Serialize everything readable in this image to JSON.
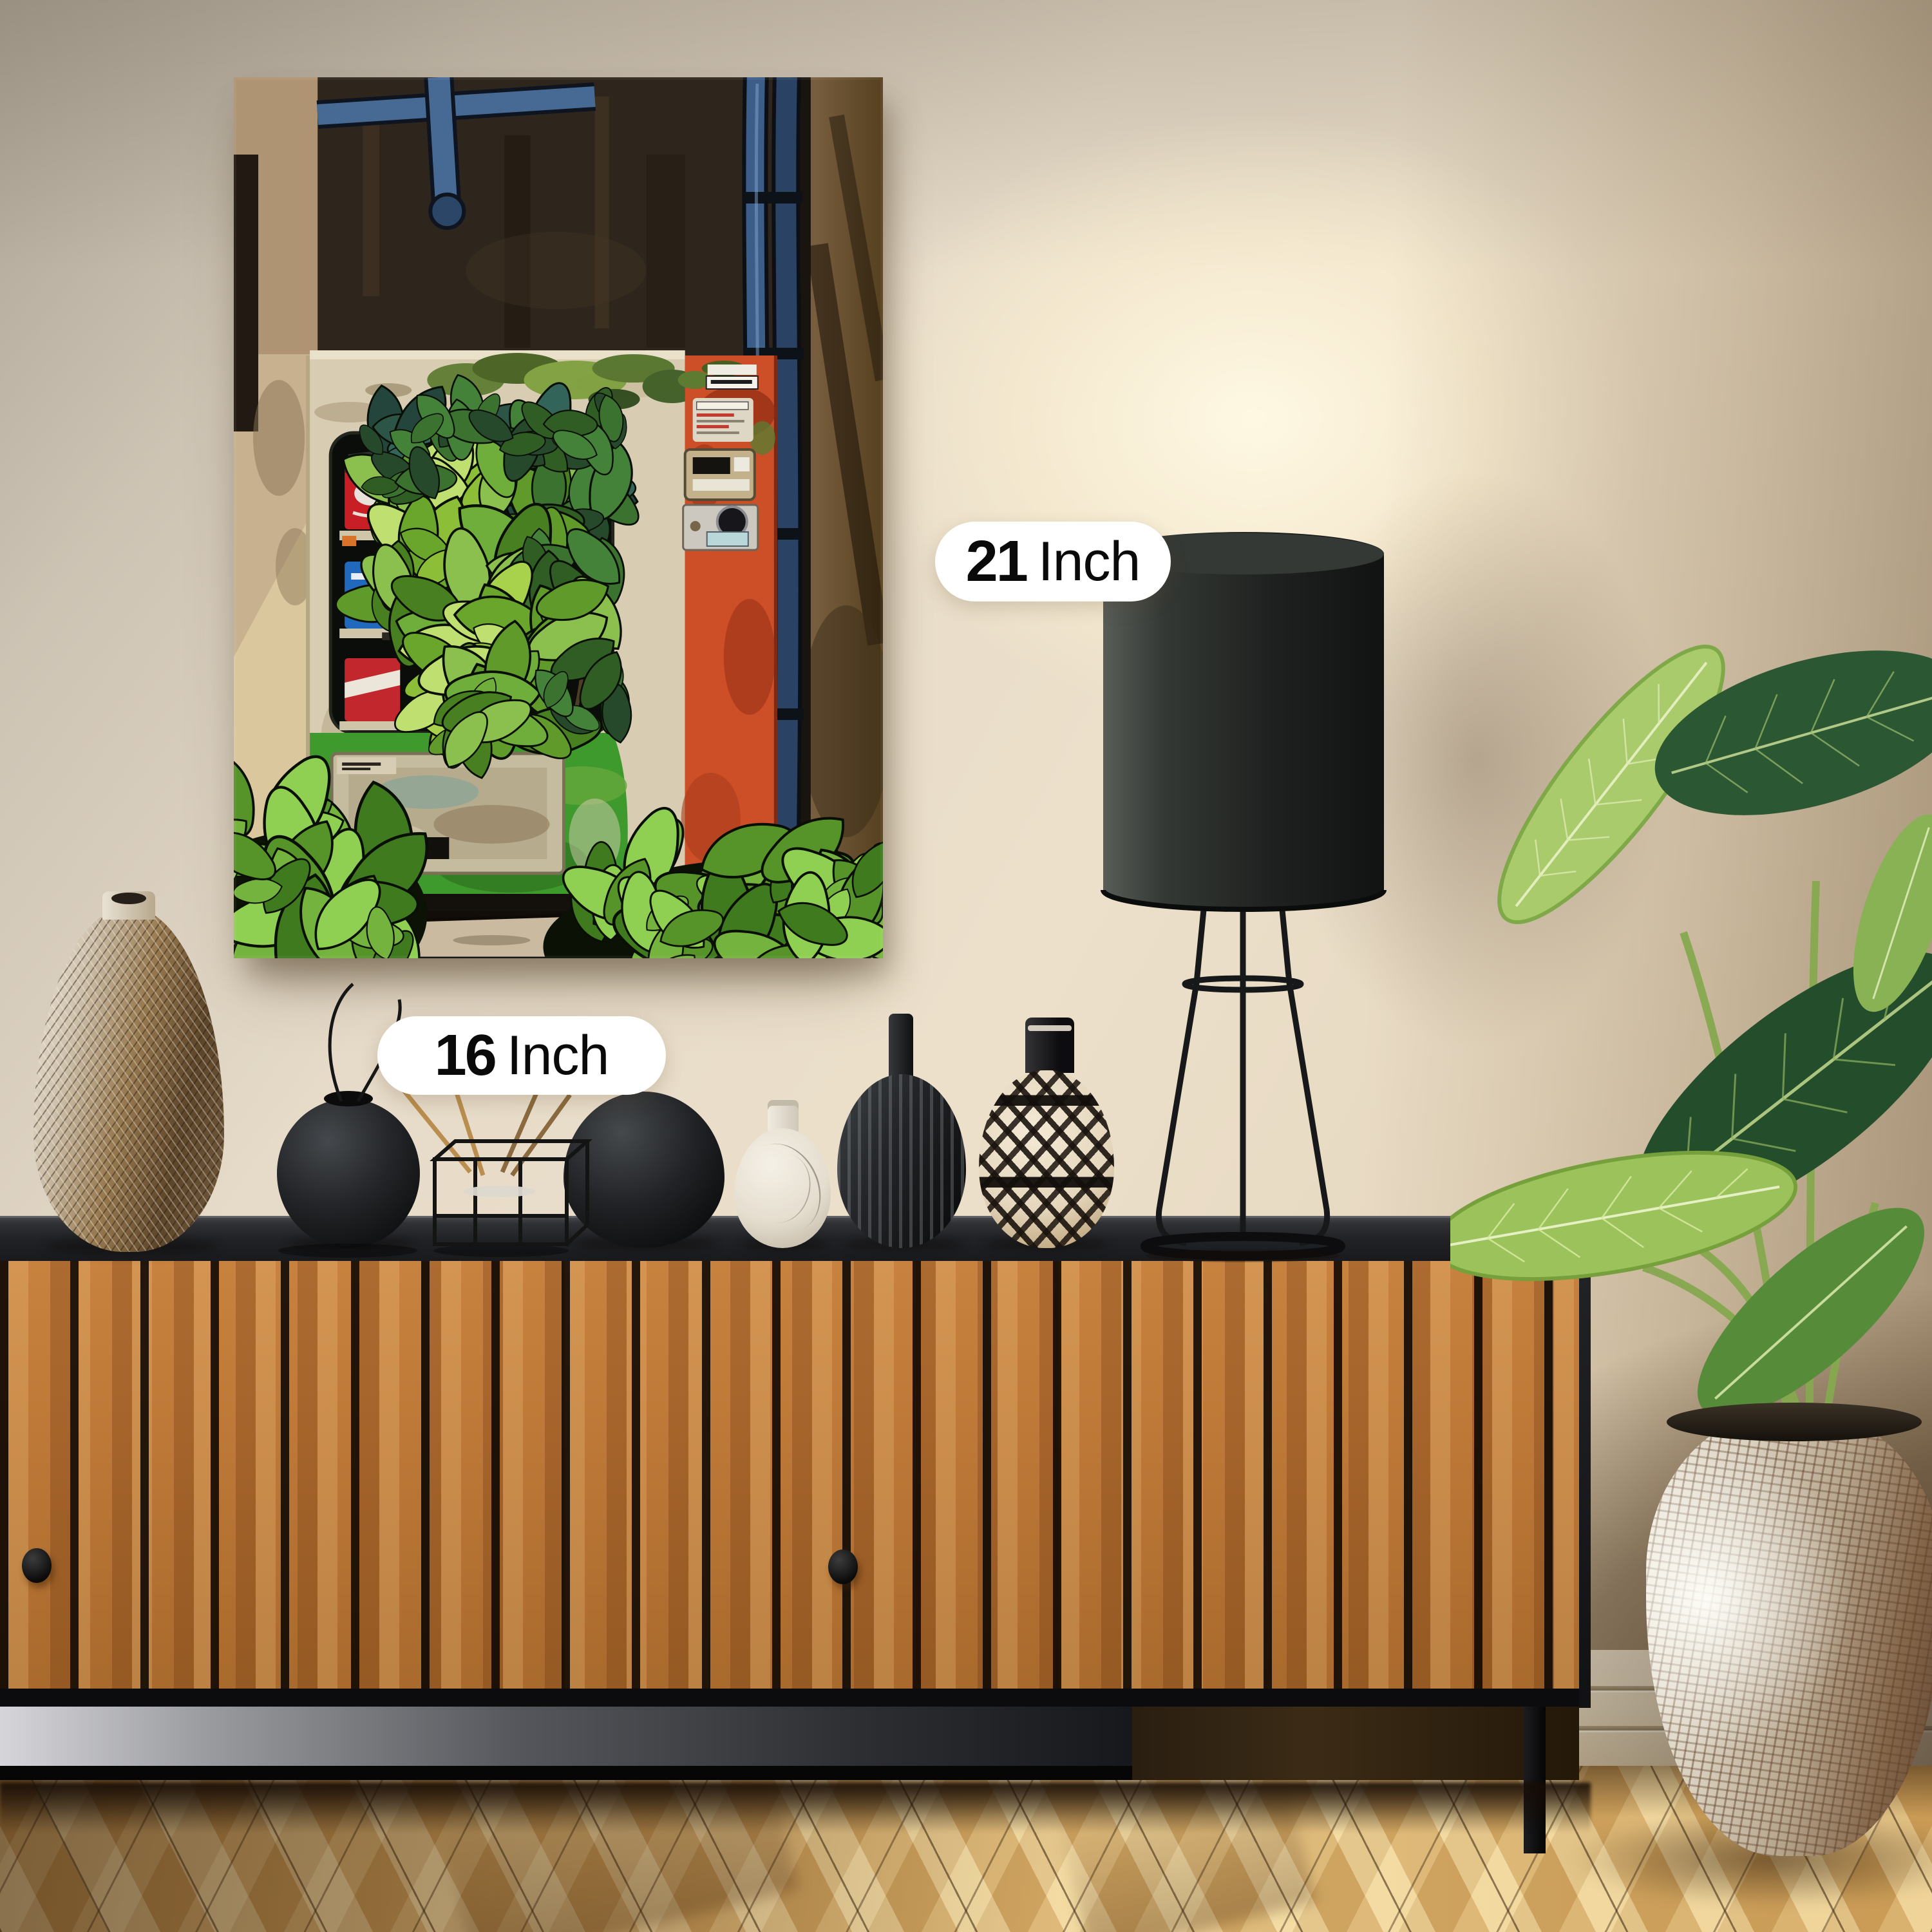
{
  "page": {
    "type": "product-mockup-photo",
    "subject": "Framed wall-art canvas of an overgrown vending machine displayed in a styled living room"
  },
  "annotations": {
    "height_label": {
      "value": "21",
      "unit": "Inch"
    },
    "width_label": {
      "value": "16",
      "unit": "Inch"
    }
  },
  "artwork": {
    "style": "anime-illustration",
    "subject": "abandoned vending machine covered in ivy",
    "orientation": "portrait",
    "palette": {
      "machine_body": "#d8cdb2",
      "machine_side_panel": "#cd4f27",
      "lower_paint": "#3f9a2e",
      "foliage": "#74b33e",
      "pipes": "#3c5d88",
      "background_wall": "#352b21"
    }
  },
  "room": {
    "wall_color": "#e6dbc9",
    "sideboard_wood_color": "#bd7837",
    "countertop_color": "#212226",
    "floor_color": "#e0b76f",
    "objects": [
      "textured-teardrop-vase",
      "black-sphere-vase",
      "wire-incense-basket",
      "black-egg-vase",
      "white-line-art-vase",
      "black-fluted-vase",
      "geometric-patterned-vase",
      "black-drum-table-lamp",
      "tropical-plant",
      "mosaic-floor-planter"
    ]
  }
}
